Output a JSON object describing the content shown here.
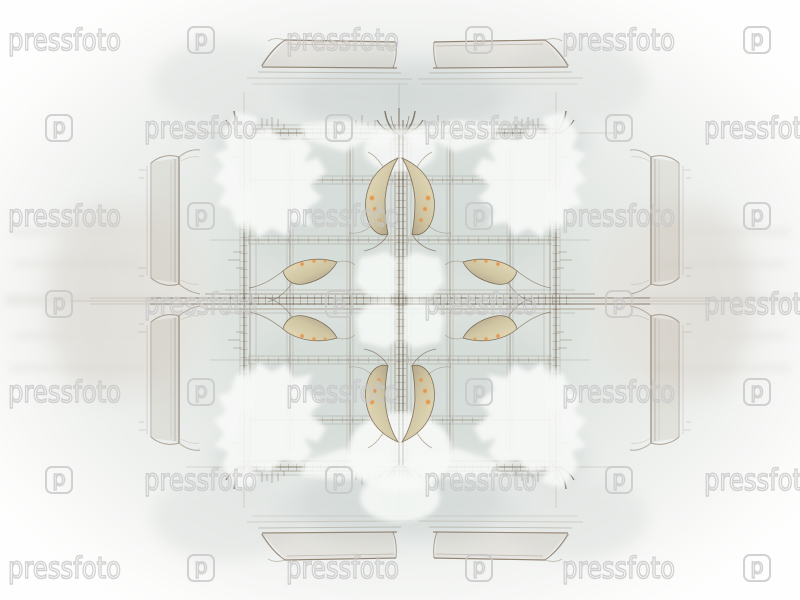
{
  "figure": {
    "kind": "abstract-fractal-artwork",
    "description": "Symmetric sepia fractal plaid with torn white clouds and golden flame accents on a pale grey-green mist, white at the edges"
  },
  "watermark": {
    "text": "pressfoto",
    "logo_letter": "p",
    "color": "#c7c7c7"
  },
  "palette": {
    "background": "#fbfbfa",
    "mist": "#d6ddd8",
    "mist_warm": "#e2e0db",
    "line_brown": "#6e5b45",
    "dark_brown": "#44331f",
    "beam_brown": "#7b6853",
    "bracket_grey_brown": "#7e6e5c",
    "gold": "#cfc5a3",
    "gold_light": "#e8dfbf",
    "gold_dark": "#b3a67f",
    "orange_glow": "#e78f3d",
    "orange_bright": "#ffcf8a",
    "white_cloud": "#f7f9f7"
  }
}
